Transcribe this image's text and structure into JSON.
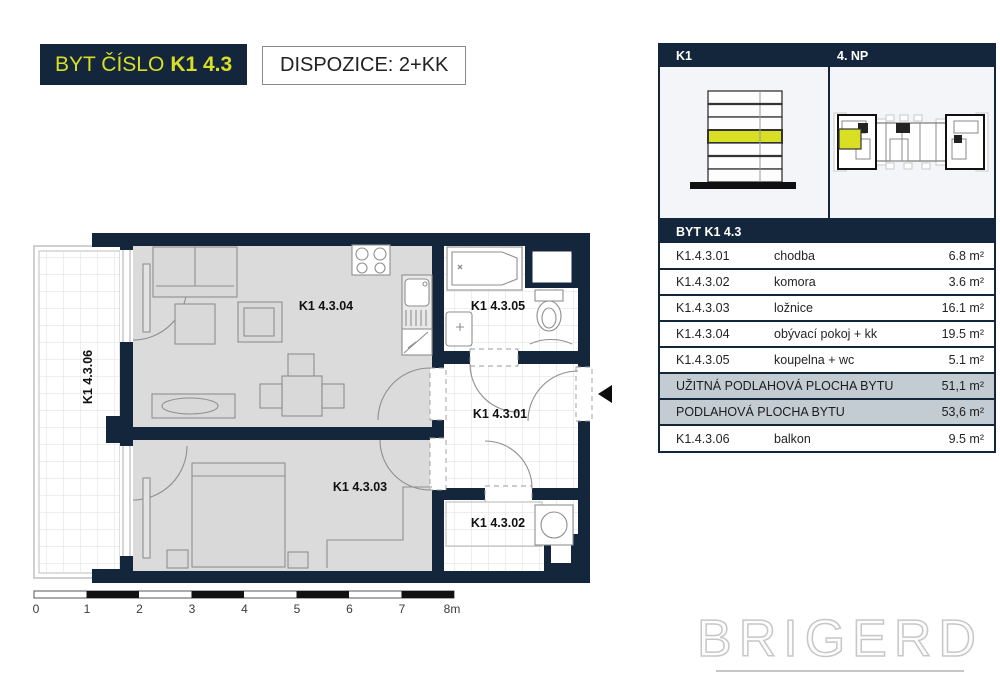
{
  "page": {
    "title_prefix": "BYT ČÍSLO",
    "title_number": "K1 4.3",
    "disposition": "DISPOZICE: 2+KK"
  },
  "info_panel": {
    "building_label": "K1",
    "floor_label": "4. NP",
    "table_title": "BYT K1 4.3",
    "rooms": [
      {
        "code": "K1.4.3.01",
        "name": "chodba",
        "area": "6.8 m²"
      },
      {
        "code": "K1.4.3.02",
        "name": "komora",
        "area": "3.6 m²"
      },
      {
        "code": "K1.4.3.03",
        "name": "ložnice",
        "area": "16.1 m²"
      },
      {
        "code": "K1.4.3.04",
        "name": "obývací pokoj + kk",
        "area": "19.5 m²"
      },
      {
        "code": "K1.4.3.05",
        "name": "koupelna + wc",
        "area": "5.1 m²"
      }
    ],
    "summary": [
      {
        "label": "UŽITNÁ PODLAHOVÁ PLOCHA BYTU",
        "area": "51,1 m²"
      },
      {
        "label": "PODLAHOVÁ PLOCHA BYTU",
        "area": "53,6 m²"
      }
    ],
    "balcony_row": {
      "code": "K1.4.3.06",
      "name": "balkon",
      "area": "9.5 m²"
    }
  },
  "floor_plan": {
    "labels": {
      "living": "K1 4.3.04",
      "bedroom": "K1 4.3.03",
      "bathroom": "K1 4.3.05",
      "hall": "K1 4.3.01",
      "storage": "K1 4.3.02",
      "balcony": "K1 4.3.06"
    },
    "scale_ticks": [
      "0",
      "1",
      "2",
      "3",
      "4",
      "5",
      "6",
      "7",
      "8m"
    ]
  },
  "watermark": "BRIGERD",
  "colors": {
    "navy": "#13263c",
    "accent_yellow": "#d8df25",
    "room_fill": "#dbdbdb",
    "summary_fill": "#c3ccd3"
  }
}
